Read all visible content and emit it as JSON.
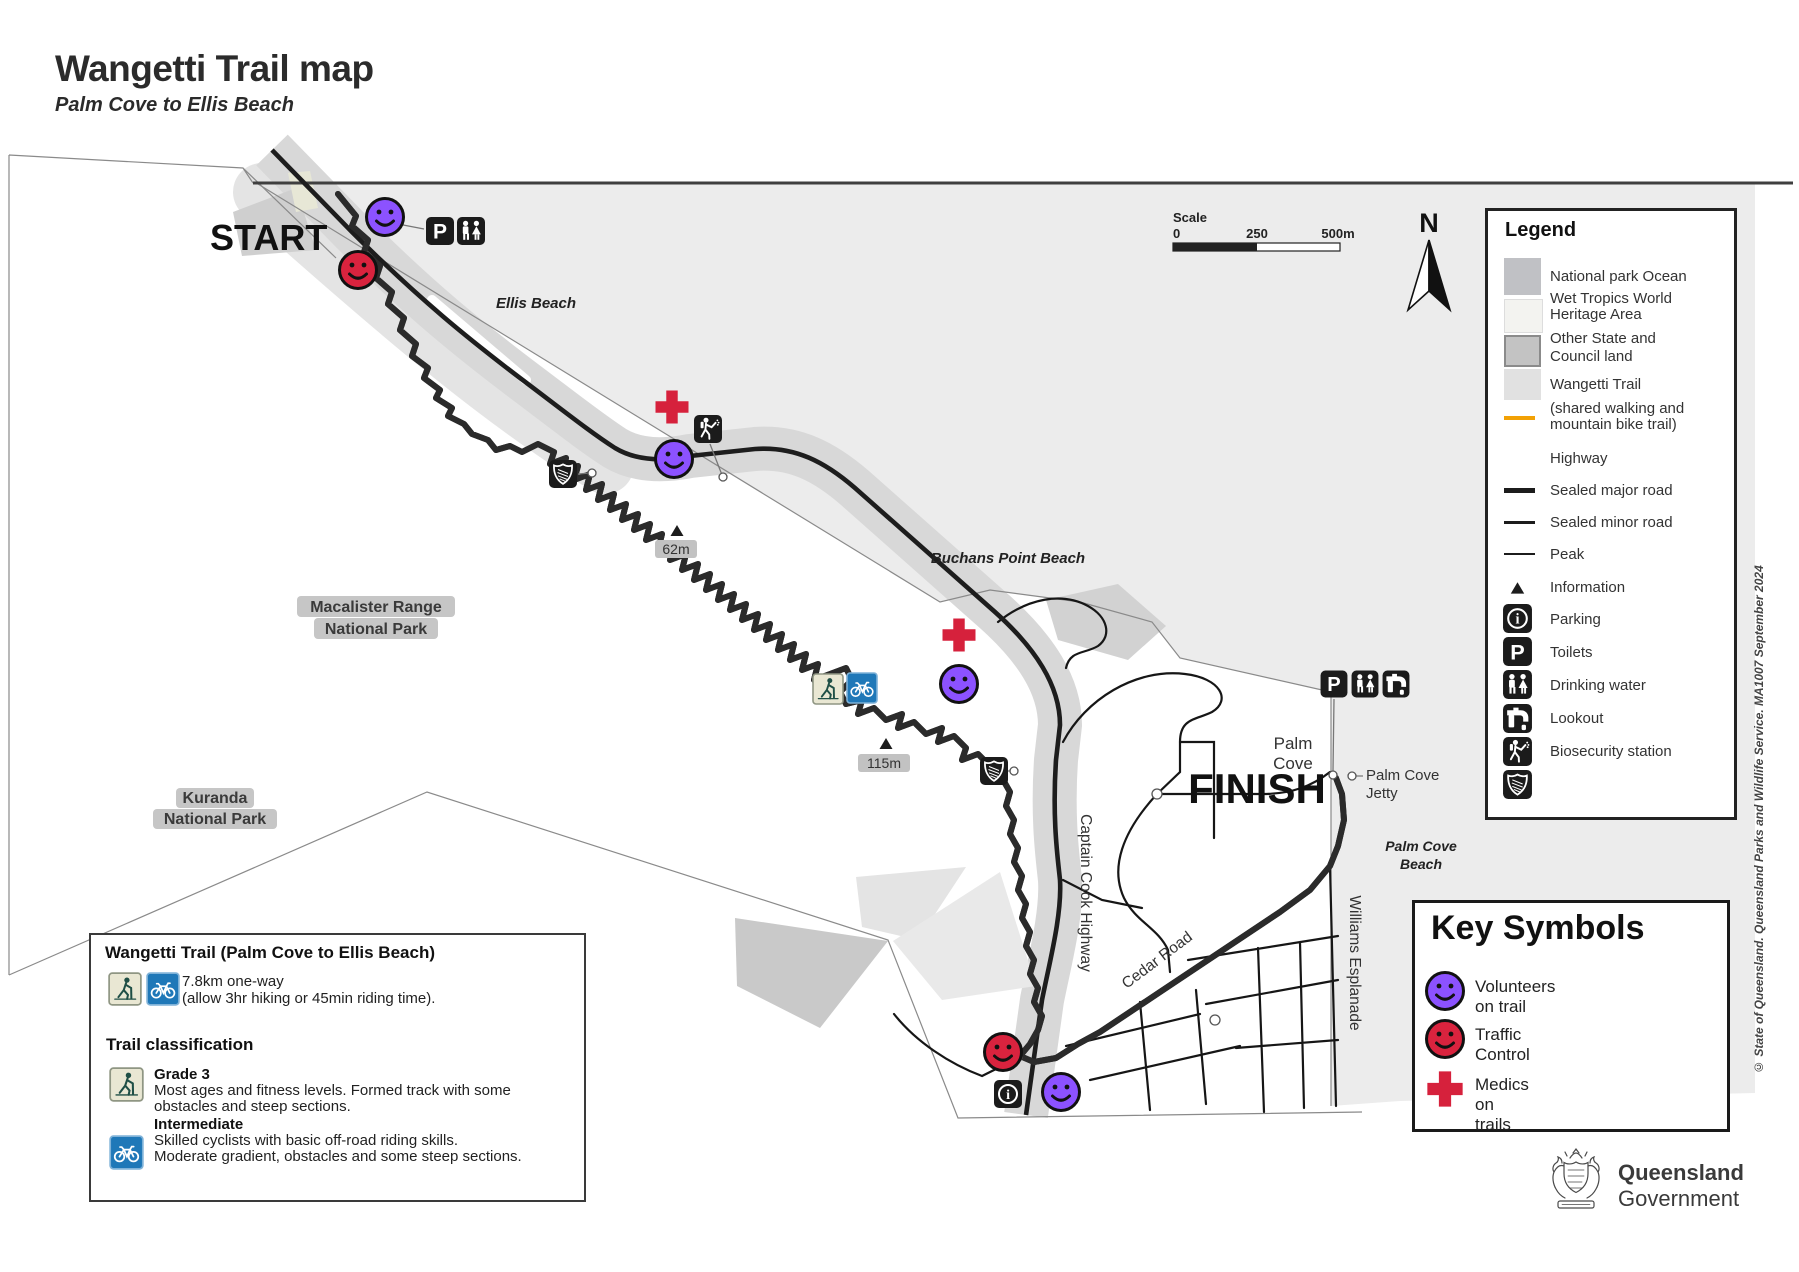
{
  "header": {
    "title": "Wangetti Trail map",
    "subtitle": "Palm Cove to Ellis Beach"
  },
  "scale": {
    "label": "Scale",
    "tick0": "0",
    "tick250": "250",
    "tick500": "500m"
  },
  "compass": {
    "label": "N"
  },
  "icons": {
    "parking_glyph": "P",
    "info_glyph": "i"
  },
  "map": {
    "start": "START",
    "finish": "FINISH",
    "ellis_beach": "Ellis Beach",
    "buchans": "Buchans Point Beach",
    "macalister": [
      "Macalister Range",
      "National Park"
    ],
    "kuranda": [
      "Kuranda",
      "National Park"
    ],
    "palm_cove": [
      "Palm",
      "Cove"
    ],
    "jetty": [
      "Palm Cove",
      "Jetty"
    ],
    "palm_cove_beach": [
      "Palm Cove",
      "Beach"
    ],
    "captain_cook": "Captain Cook Highway",
    "cedar_road": "Cedar Road",
    "williams": "Williams Esplanade",
    "peak62": "62m",
    "peak115": "115m"
  },
  "legend": {
    "title": "Legend",
    "areas": [
      {
        "label1": "National park Ocean",
        "label2": ""
      },
      {
        "label1": "Wet Tropics World",
        "label2": "Heritage Area"
      },
      {
        "label1": "Other State and",
        "label2": "Council land"
      },
      {
        "label1": "Wangetti Trail",
        "label2": ""
      },
      {
        "label1": "(shared walking and",
        "label2": "mountain bike trail)"
      }
    ],
    "lines": [
      {
        "label": "Highway"
      },
      {
        "label": "Sealed major road"
      },
      {
        "label": "Sealed minor road"
      },
      {
        "label": "Peak"
      }
    ],
    "points": [
      {
        "label": "Information"
      },
      {
        "label": "Parking"
      },
      {
        "label": "Toilets"
      },
      {
        "label": "Drinking water"
      },
      {
        "label": "Lookout"
      },
      {
        "label": "Biosecurity station"
      },
      {
        "label": ""
      }
    ]
  },
  "key_symbols": {
    "title": "Key Symbols",
    "items": [
      {
        "label": "Volunteers on trail"
      },
      {
        "label": "Traffic Control"
      },
      {
        "label": "Medics on trails"
      }
    ]
  },
  "info_box": {
    "title": "Wangetti Trail (Palm Cove to Ellis Beach)",
    "distance1": "7.8km one-way",
    "distance2": "(allow 3hr hiking or 45min riding time).",
    "classification_title": "Trail classification",
    "grade_title": "Grade 3",
    "grade_line1": "Most ages and fitness levels. Formed track with some",
    "grade_line2": "obstacles and steep sections.",
    "intermediate_title": "Intermediate",
    "intermediate_line1": "Skilled cyclists with basic off-road riding skills.",
    "intermediate_line2": "Moderate gradient, obstacles and some steep sections."
  },
  "copyright": "© State of Queensland. Queensland Parks and Wildlife Service. MA1007 September 2024",
  "government": {
    "name": "Queensland",
    "dept": "Government"
  },
  "colors": {
    "ocean": "#ececec",
    "council_band": "#d8d8d8",
    "trail_corridor": "#e4e4e4",
    "trail_orange": "#f2a105",
    "highway_black": "#1d1d1d",
    "smiley_purple": "#8c52ff",
    "smiley_red": "#d9233e",
    "medic_red": "#d6213c",
    "icon_black": "#1b1b1b",
    "label_halo": "#c6c6c6",
    "hiker_badge_bg": "#e9e7d3",
    "hiker_badge_fg": "#1f4f46",
    "bike_badge_bg": "#1f78b8"
  }
}
